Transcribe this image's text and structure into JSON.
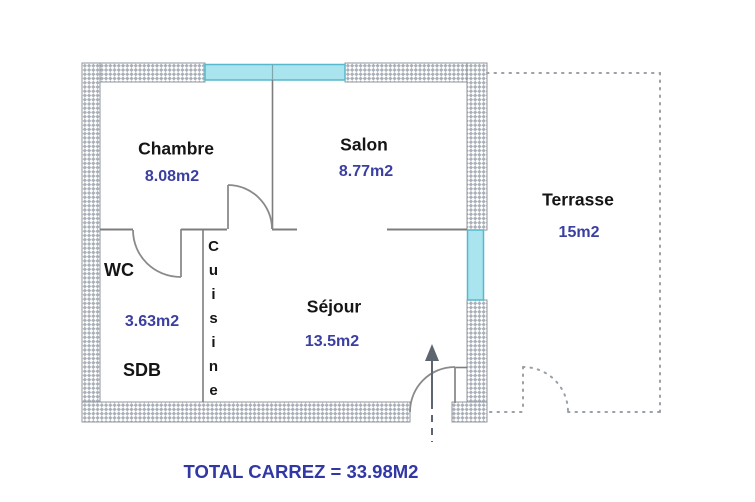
{
  "plan_title": "apartment-floor-plan",
  "rooms": {
    "chambre": {
      "name": "Chambre",
      "area": "8.08m2"
    },
    "salon": {
      "name": "Salon",
      "area": "8.77m2"
    },
    "wc": {
      "name": "WC",
      "area": "3.63m2"
    },
    "sdb": {
      "name": "SDB"
    },
    "cuisine": {
      "name": "Cuisine"
    },
    "sejour": {
      "name": "Séjour",
      "area": "13.5m2"
    },
    "terrasse": {
      "name": "Terrasse",
      "area": "15m2"
    }
  },
  "total": "TOTAL CARREZ = 33.98M2",
  "colors": {
    "room_text": "#151515",
    "area_text": "#3b3fa0",
    "total_text": "#3138a5",
    "window_fill": "#a9e4ef",
    "window_stroke": "#56b8cb",
    "wall_hatch": "#aab0b8",
    "wall_border": "#8f949c",
    "interior_line": "#7d7d7d",
    "arrow": "#5d6570",
    "terrace_dots": "#9aa0a8"
  }
}
